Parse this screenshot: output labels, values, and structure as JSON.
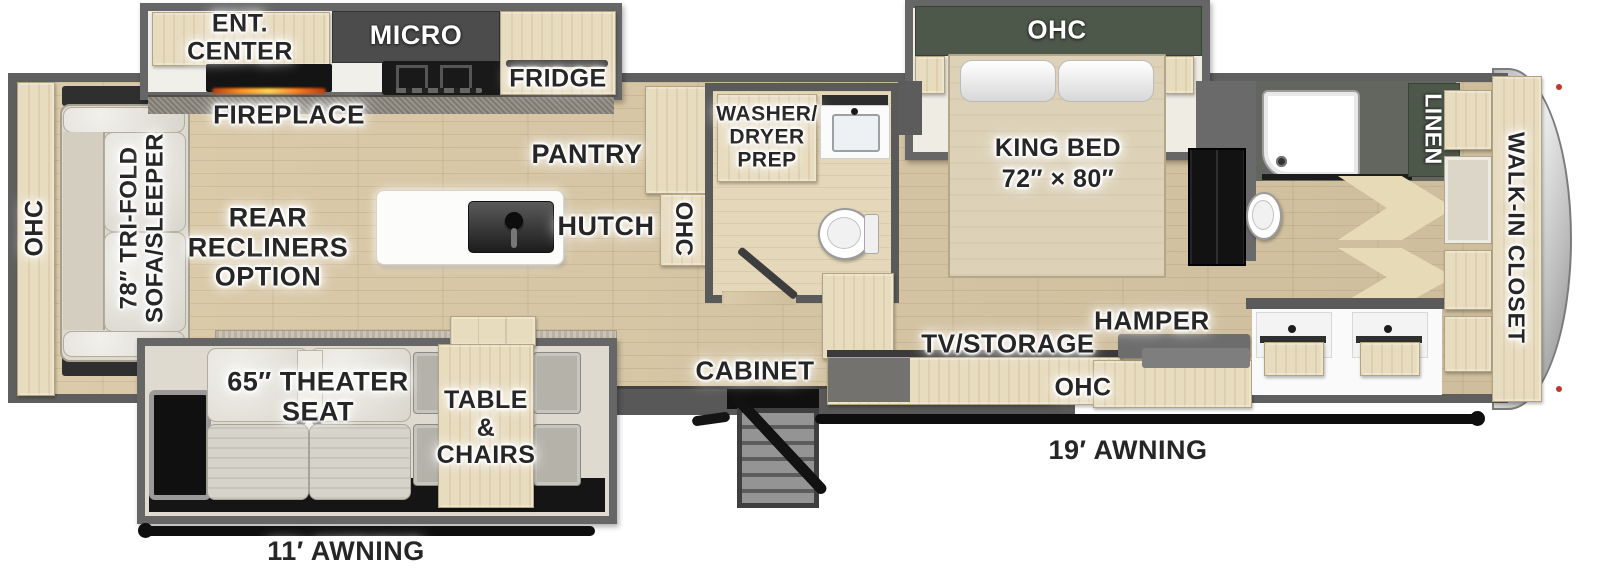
{
  "title": "Fifth wheel RV floor plan",
  "colors": {
    "wall": "#5c5c5c",
    "floor_wood": "#d9c8a5",
    "cabinet_wood": "#e8dcbf",
    "accent_green": "#4d574a",
    "appliance_dark": "#1b1b1b",
    "cap_silver": "#c9c9c9",
    "label_text": "#262626"
  },
  "labels": {
    "ohc": "OHC",
    "ent_center": [
      "ENT.",
      "CENTER"
    ],
    "micro": "MICRO",
    "fridge": "FRIDGE",
    "fireplace": "FIREPLACE",
    "pantry": "PANTRY",
    "hutch": "HUTCH",
    "washer_dryer": [
      "WASHER/",
      "DRYER",
      "PREP"
    ],
    "king_bed": [
      "KING BED",
      "72″ × 80″"
    ],
    "linen": "LINEN",
    "walk_in_closet": "WALK-IN CLOSET",
    "tri_fold_sofa": [
      "78″ TRI-FOLD",
      "SOFA/SLEEPER"
    ],
    "rear_recliners": [
      "REAR",
      "RECLINERS",
      "OPTION"
    ],
    "tv_storage": "TV/STORAGE",
    "hamper": "HAMPER",
    "cabinet": "CABINET",
    "theater_seat": [
      "65″ THEATER",
      "SEAT"
    ],
    "table_chairs": [
      "TABLE",
      "&",
      "CHAIRS"
    ],
    "awning_19": "19′ AWNING",
    "awning_11": "11′ AWNING"
  }
}
